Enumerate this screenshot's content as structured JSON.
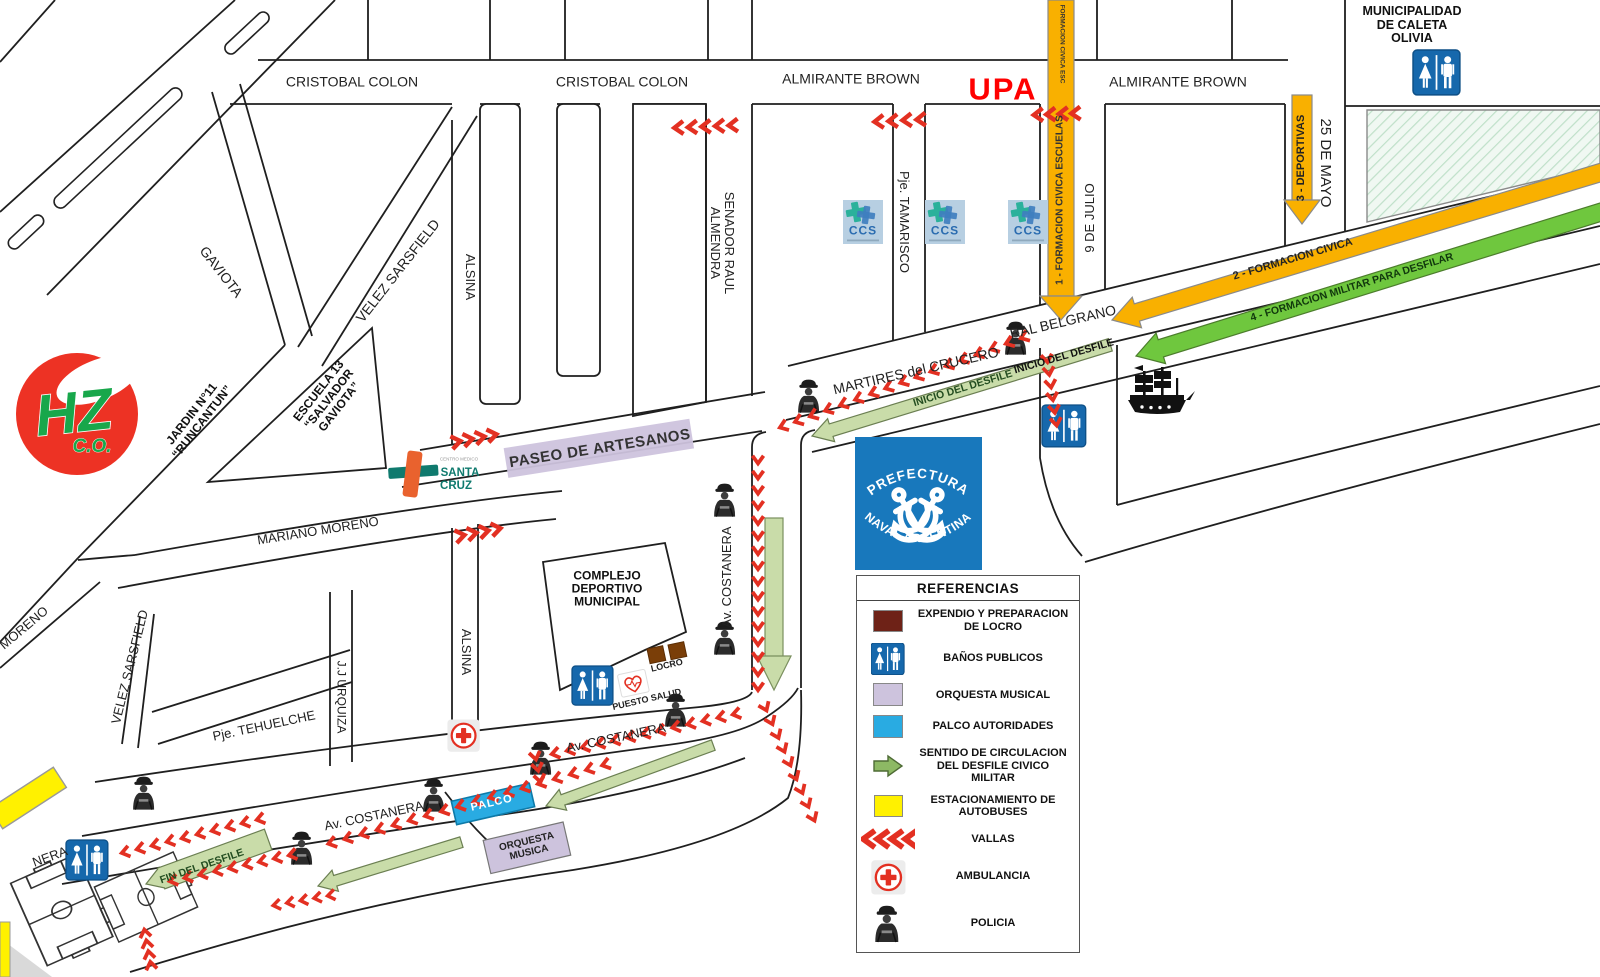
{
  "map": {
    "streets": {
      "cristobal_colon": "CRISTOBAL COLON",
      "almirante_brown": "ALMIRANTE BROWN",
      "gaviota": "GAVIOTA",
      "velez_sarsfield": "VELEZ SARSFIELD",
      "alsina": "ALSINA",
      "senador_raul_l1": "SENADOR RAUL",
      "senador_raul_l2": "ALMENDRA",
      "pje_tamarisco": "Pje. TAMARISCO",
      "nueve_de_julio": "9 DE JULIO",
      "veinticinco_de_mayo": "25 DE MAYO",
      "martires_crucero": "MARTIRES del CRUCERO",
      "gral_belgrano": "RAL BELGRANO",
      "paseo_artesanos": "PASEO DE ARTESANOS",
      "mariano_moreno": "MARIANO MORENO",
      "moreno": "MORENO",
      "av_costanera": "Av. COSTANERA",
      "pje_tehuelche": "Pje. TEHUELCHE",
      "jj_urquiza": "J.J URQUIZA",
      "costanera_partial": "NERA"
    },
    "pois": {
      "upa": "UPA",
      "municipalidad": [
        "MUNICIPALIDAD",
        "DE CALETA",
        "OLIVIA"
      ],
      "jardin": [
        "JARDIN N°11",
        "“RUNCANTUN”"
      ],
      "escuela": [
        "ESCUELA 13",
        "“SALVADOR",
        "GAVIOTA”"
      ],
      "complejo": [
        "COMPLEJO",
        "DEPORTIVO",
        "MUNICIPAL"
      ],
      "locro": "LOCRO",
      "puesto_salud": "PUESTO SALUD",
      "palco": "PALCO",
      "orquesta": [
        "ORQUESTA",
        "MUSICA"
      ],
      "hz": "HZ",
      "hz_sub": "C.O.",
      "santa_cruz_sup": "CENTRO MEDICO",
      "santa_cruz": [
        "SANTA",
        "CRUZ"
      ],
      "ccs": "CCS",
      "prefectura_top": "PREFECTURA",
      "prefectura_bottom": "NAVAL ARGENTINA"
    },
    "route": {
      "inicio": "INICIO DEL DESFILE",
      "fin": "FIN DEL DESFILE",
      "f1": "1 - FORMACION CIVICA ESCUELAS",
      "f1_top": "FORMACION CIVICA ESC",
      "f2": "2 - FORMACION CIVICA",
      "f3": "3 - DEPORTIVAS",
      "f4": "4 - FORMACION MILITAR PARA DESFILAR"
    },
    "legend": {
      "title": "REFERENCIAS",
      "items": [
        {
          "icon": "locro-swatch",
          "label": "EXPENDIO Y PREPARACION DE LOCRO"
        },
        {
          "icon": "restroom-icon",
          "label": "BAÑOS PUBLICOS"
        },
        {
          "icon": "orquesta-swatch",
          "label": "ORQUESTA MUSICAL"
        },
        {
          "icon": "palco-swatch",
          "label": "PALCO AUTORIDADES"
        },
        {
          "icon": "green-arrow-icon",
          "label": "SENTIDO DE CIRCULACION DEL DESFILE CIVICO MILITAR"
        },
        {
          "icon": "parking-swatch",
          "label": "ESTACIONAMIENTO DE AUTOBUSES"
        },
        {
          "icon": "vallas-icon",
          "label": "VALLAS"
        },
        {
          "icon": "ambulance-icon",
          "label": "AMBULANCIA"
        },
        {
          "icon": "police-icon",
          "label": "POLICIA"
        }
      ]
    },
    "colors": {
      "orange_arrow": "#F9B000",
      "green_arrow": "#6FC73E",
      "pale_green_band": "#C9DCA9",
      "lavender": "#CDC3DD",
      "cyan_palco": "#29ABE2",
      "yellow_parking": "#FFF100",
      "red_vallas": "#E33022",
      "upa_red": "#FF0000",
      "locro_brown": "#7A3E08",
      "maroon_swatch": "#6E2217",
      "restroom_blue": "#1668AC",
      "prefectura_blue": "#1878BC",
      "hz_red": "#ED3224",
      "hz_green": "#18A74B",
      "santa_cruz_teal": "#0F7A6E"
    }
  }
}
